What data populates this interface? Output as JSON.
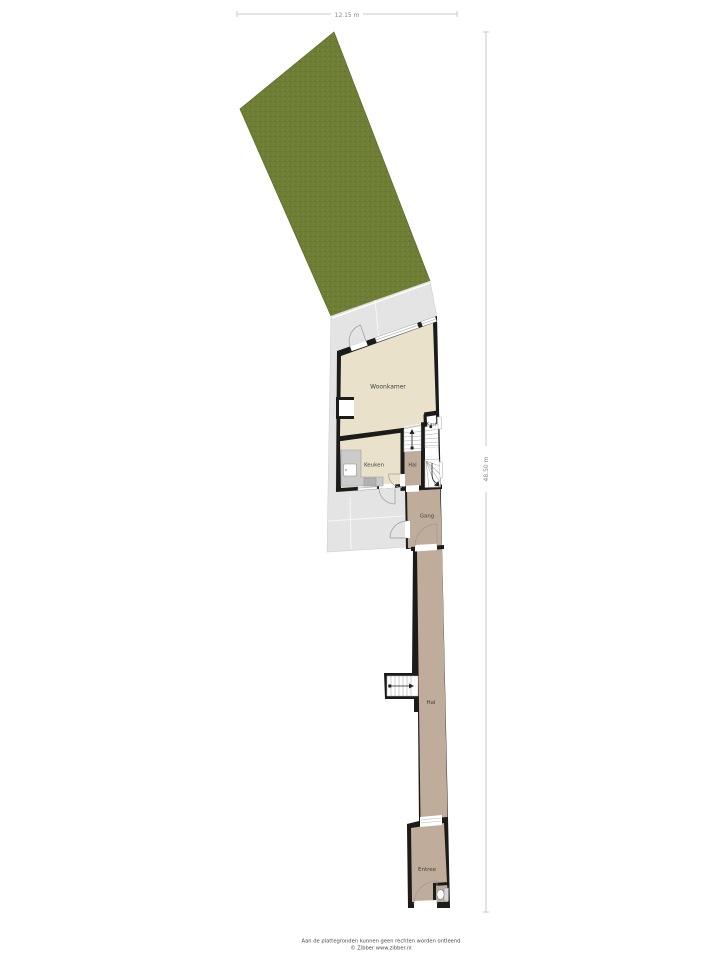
{
  "dimensions": {
    "width_label": "12.15 m",
    "depth_label": "48.50 m"
  },
  "rooms": {
    "woonkamer": "Woonkamer",
    "keuken": "Keuken",
    "kast": "Kast",
    "hal": "Hal",
    "gang": "Gang",
    "hal2": "Hal",
    "entree": "Entree"
  },
  "footer": {
    "disclaimer": "Aan de plattegronden kunnen geen rechten worden ontleend",
    "credit": "© Zibber www.zibber.nl"
  },
  "colors": {
    "garden": "#6f7e35",
    "terrace": "#e4e4e4",
    "wall": "#1b1b19",
    "floor_main": "#e9e1ca",
    "floor_hall": "#c0ac9a",
    "counter": "#cbcbcb",
    "stair": "#ffffff",
    "dimension_line": "#c9c9c9",
    "label_text": "#3f3f3f",
    "footer_text": "#4a4a4a"
  }
}
